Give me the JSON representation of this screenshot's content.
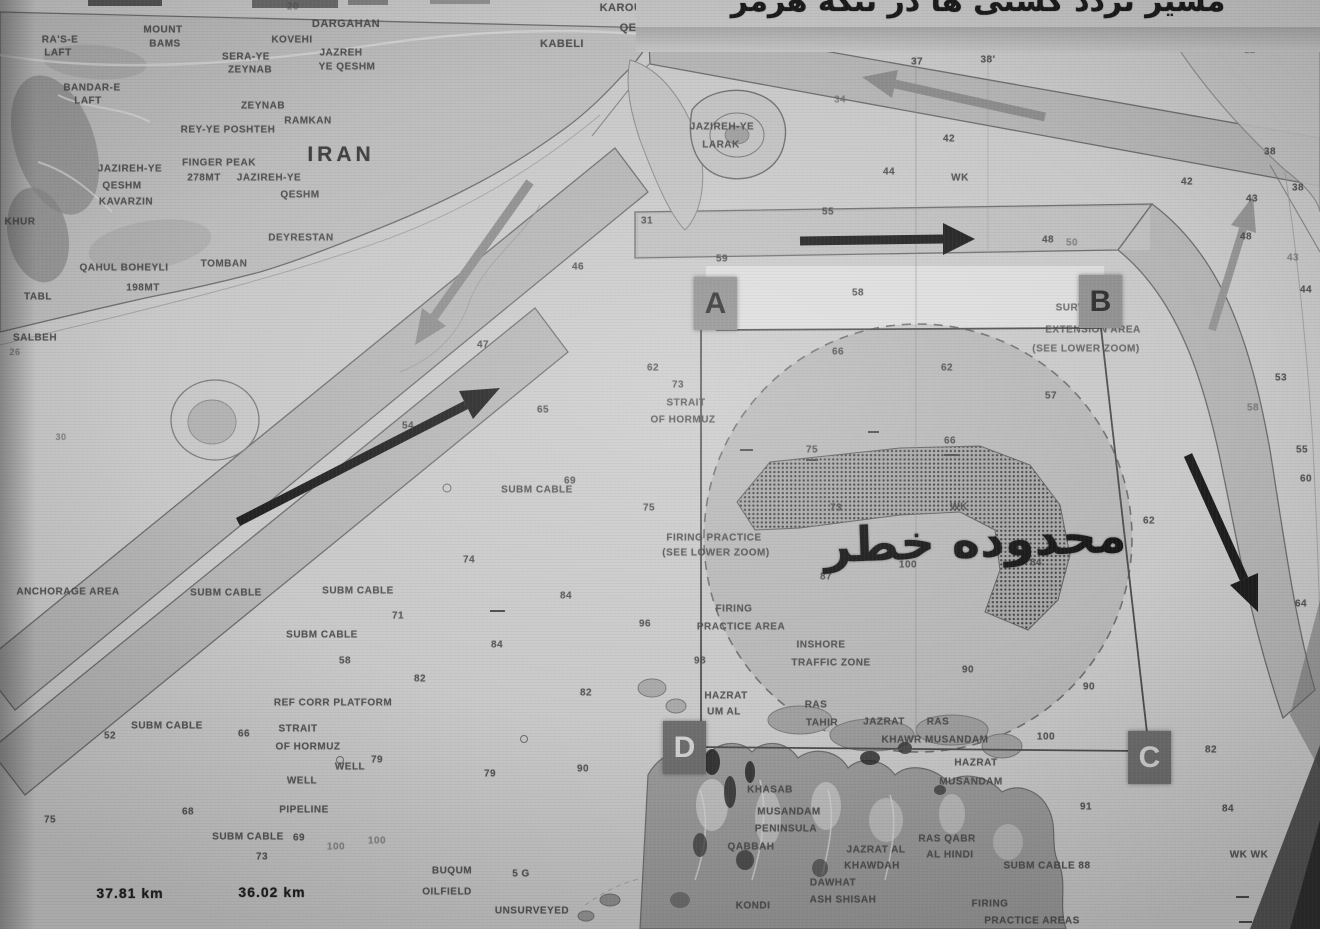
{
  "caption": {
    "text": "مسیر تردد کشتی ها در تنگه هرمز"
  },
  "danger_zone_label": "محدوده خطر",
  "markers": {
    "a": "A",
    "b": "B",
    "c": "C",
    "d": "D"
  },
  "colors": {
    "paper": "#c9c9c9",
    "land": "#bdbdbd",
    "dark_land": "#9a9a9a",
    "lane_fill": "#6e6e6e",
    "ink": "#474747",
    "arrow_black": "#1e1e1e",
    "arrow_gray": "#8d8d8d"
  },
  "labels": [
    {
      "t": "20",
      "x": 293,
      "y": 7,
      "s": 10,
      "c": "faint"
    },
    {
      "t": "KAROU",
      "x": 621,
      "y": 8,
      "s": 11
    },
    {
      "t": "QESHM",
      "x": 641,
      "y": 28,
      "s": 11
    },
    {
      "t": "KABELI",
      "x": 562,
      "y": 44,
      "s": 11
    },
    {
      "t": "DARGAHAN",
      "x": 346,
      "y": 24,
      "s": 11
    },
    {
      "t": "KOVEHI",
      "x": 292,
      "y": 40,
      "s": 10
    },
    {
      "t": "JAZREH",
      "x": 341,
      "y": 53,
      "s": 10
    },
    {
      "t": "YE QESHM",
      "x": 347,
      "y": 67,
      "s": 10
    },
    {
      "t": "SERA-YE",
      "x": 246,
      "y": 57,
      "s": 10
    },
    {
      "t": "ZEYNAB",
      "x": 250,
      "y": 70,
      "s": 10
    },
    {
      "t": "MOUNT",
      "x": 163,
      "y": 30,
      "s": 10
    },
    {
      "t": "BAMS",
      "x": 165,
      "y": 44,
      "s": 10
    },
    {
      "t": "RA'S-E",
      "x": 60,
      "y": 40,
      "s": 10
    },
    {
      "t": "LAFT",
      "x": 58,
      "y": 53,
      "s": 10
    },
    {
      "t": "BANDAR-E",
      "x": 92,
      "y": 88,
      "s": 10
    },
    {
      "t": "LAFT",
      "x": 88,
      "y": 101,
      "s": 10
    },
    {
      "t": "ZEYNAB",
      "x": 263,
      "y": 106,
      "s": 10
    },
    {
      "t": "RAMKAN",
      "x": 308,
      "y": 121,
      "s": 10
    },
    {
      "t": "REY-YE POSHTEH",
      "x": 228,
      "y": 130,
      "s": 10
    },
    {
      "t": "IRAN",
      "x": 341,
      "y": 155,
      "s": 21,
      "c": "big"
    },
    {
      "t": "FINGER PEAK",
      "x": 219,
      "y": 163,
      "s": 10
    },
    {
      "t": "278MT",
      "x": 204,
      "y": 178,
      "s": 10
    },
    {
      "t": "JAZIREH-YE",
      "x": 269,
      "y": 178,
      "s": 10
    },
    {
      "t": "QESHM",
      "x": 300,
      "y": 195,
      "s": 10
    },
    {
      "t": "JAZIREH-YE",
      "x": 130,
      "y": 169,
      "s": 10
    },
    {
      "t": "QESHM",
      "x": 122,
      "y": 186,
      "s": 10
    },
    {
      "t": "KAVARZIN",
      "x": 126,
      "y": 202,
      "s": 10
    },
    {
      "t": "KHUR",
      "x": 20,
      "y": 222,
      "s": 10
    },
    {
      "t": "DEYRESTAN",
      "x": 301,
      "y": 238,
      "s": 10
    },
    {
      "t": "QAHUL BOHEYLI",
      "x": 124,
      "y": 268,
      "s": 10
    },
    {
      "t": "TOMBAN",
      "x": 224,
      "y": 264,
      "s": 10
    },
    {
      "t": "198MT",
      "x": 143,
      "y": 288,
      "s": 10
    },
    {
      "t": "TABL",
      "x": 38,
      "y": 297,
      "s": 10
    },
    {
      "t": "SALBEH",
      "x": 35,
      "y": 338,
      "s": 10
    },
    {
      "t": "26",
      "x": 15,
      "y": 352,
      "s": 9,
      "c": "faint"
    },
    {
      "t": "30",
      "x": 61,
      "y": 437,
      "s": 9,
      "c": "faint"
    },
    {
      "t": "JAZIREH-YE",
      "x": 722,
      "y": 127,
      "s": 10
    },
    {
      "t": "LARAK",
      "x": 721,
      "y": 145,
      "s": 10
    },
    {
      "t": "37",
      "x": 917,
      "y": 62,
      "s": 10
    },
    {
      "t": "38'",
      "x": 988,
      "y": 60,
      "s": 10
    },
    {
      "t": "34",
      "x": 840,
      "y": 100,
      "s": 10,
      "c": "faint"
    },
    {
      "t": "42",
      "x": 949,
      "y": 139,
      "s": 10
    },
    {
      "t": "44",
      "x": 889,
      "y": 172,
      "s": 10
    },
    {
      "t": "WK",
      "x": 960,
      "y": 178,
      "s": 10
    },
    {
      "t": "WK",
      "x": 1297,
      "y": 8,
      "s": 10,
      "c": "faint"
    },
    {
      "t": "22",
      "x": 1250,
      "y": 50,
      "s": 9,
      "c": "faint"
    },
    {
      "t": "38",
      "x": 1270,
      "y": 152,
      "s": 10
    },
    {
      "t": "38",
      "x": 1298,
      "y": 188,
      "s": 10
    },
    {
      "t": "42",
      "x": 1187,
      "y": 182,
      "s": 10
    },
    {
      "t": "43",
      "x": 1252,
      "y": 199,
      "s": 10
    },
    {
      "t": "48",
      "x": 1246,
      "y": 237,
      "s": 10
    },
    {
      "t": "43",
      "x": 1293,
      "y": 258,
      "s": 10,
      "c": "faint"
    },
    {
      "t": "44",
      "x": 1306,
      "y": 290,
      "s": 10
    },
    {
      "t": "31",
      "x": 647,
      "y": 221,
      "s": 10
    },
    {
      "t": "55",
      "x": 828,
      "y": 212,
      "s": 10
    },
    {
      "t": "59",
      "x": 722,
      "y": 259,
      "s": 10
    },
    {
      "t": "46",
      "x": 578,
      "y": 267,
      "s": 10
    },
    {
      "t": "48",
      "x": 1048,
      "y": 240,
      "s": 10
    },
    {
      "t": "50",
      "x": 1072,
      "y": 243,
      "s": 10,
      "c": "faint"
    },
    {
      "t": "58",
      "x": 858,
      "y": 293,
      "s": 10
    },
    {
      "t": "SURVEYED",
      "x": 1085,
      "y": 308,
      "s": 10,
      "c": "note"
    },
    {
      "t": "EXTENSION AREA",
      "x": 1093,
      "y": 330,
      "s": 10,
      "c": "note"
    },
    {
      "t": "(SEE LOWER ZOOM)",
      "x": 1086,
      "y": 349,
      "s": 10,
      "c": "note"
    },
    {
      "t": "66",
      "x": 838,
      "y": 352,
      "s": 10
    },
    {
      "t": "62",
      "x": 947,
      "y": 368,
      "s": 10
    },
    {
      "t": "57",
      "x": 1051,
      "y": 396,
      "s": 10
    },
    {
      "t": "62",
      "x": 653,
      "y": 368,
      "s": 10
    },
    {
      "t": "73",
      "x": 678,
      "y": 385,
      "s": 10
    },
    {
      "t": "STRAIT",
      "x": 686,
      "y": 403,
      "s": 10
    },
    {
      "t": "OF HORMUZ",
      "x": 683,
      "y": 420,
      "s": 10
    },
    {
      "t": "47",
      "x": 483,
      "y": 345,
      "s": 10
    },
    {
      "t": "54",
      "x": 408,
      "y": 426,
      "s": 10
    },
    {
      "t": "65",
      "x": 543,
      "y": 410,
      "s": 10
    },
    {
      "t": "69",
      "x": 570,
      "y": 481,
      "s": 10
    },
    {
      "t": "SUBM CABLE",
      "x": 537,
      "y": 490,
      "s": 10
    },
    {
      "t": "75",
      "x": 649,
      "y": 508,
      "s": 10
    },
    {
      "t": "75",
      "x": 812,
      "y": 450,
      "s": 10
    },
    {
      "t": "66",
      "x": 950,
      "y": 441,
      "s": 10
    },
    {
      "t": "FIRING PRACTICE",
      "x": 714,
      "y": 538,
      "s": 10
    },
    {
      "t": "(SEE LOWER ZOOM)",
      "x": 716,
      "y": 553,
      "s": 10
    },
    {
      "t": "73",
      "x": 836,
      "y": 508,
      "s": 10
    },
    {
      "t": "WK",
      "x": 959,
      "y": 507,
      "s": 10
    },
    {
      "t": "100",
      "x": 908,
      "y": 565,
      "s": 10
    },
    {
      "t": "84",
      "x": 1036,
      "y": 563,
      "s": 10
    },
    {
      "t": "87",
      "x": 826,
      "y": 577,
      "s": 10
    },
    {
      "t": "74",
      "x": 469,
      "y": 560,
      "s": 10
    },
    {
      "t": "84",
      "x": 566,
      "y": 596,
      "s": 10
    },
    {
      "t": "58",
      "x": 345,
      "y": 661,
      "s": 10
    },
    {
      "t": "82",
      "x": 420,
      "y": 679,
      "s": 10
    },
    {
      "t": "SUBM CABLE",
      "x": 226,
      "y": 593,
      "s": 10
    },
    {
      "t": "SUBM CABLE",
      "x": 358,
      "y": 591,
      "s": 10
    },
    {
      "t": "SUBM CABLE",
      "x": 322,
      "y": 635,
      "s": 10
    },
    {
      "t": "SUBM CABLE",
      "x": 167,
      "y": 726,
      "s": 10
    },
    {
      "t": "SUBM CABLE",
      "x": 248,
      "y": 837,
      "s": 10
    },
    {
      "t": "ANCHORAGE AREA",
      "x": 68,
      "y": 592,
      "s": 10
    },
    {
      "t": "71",
      "x": 398,
      "y": 616,
      "s": 10
    },
    {
      "t": "84",
      "x": 497,
      "y": 645,
      "s": 10
    },
    {
      "t": "REF CORR PLATFORM",
      "x": 333,
      "y": 703,
      "s": 10
    },
    {
      "t": "STRAIT",
      "x": 298,
      "y": 729,
      "s": 10
    },
    {
      "t": "OF HORMUZ",
      "x": 308,
      "y": 747,
      "s": 10
    },
    {
      "t": "66",
      "x": 244,
      "y": 734,
      "s": 10
    },
    {
      "t": "52",
      "x": 110,
      "y": 736,
      "s": 10
    },
    {
      "t": "WELL",
      "x": 350,
      "y": 767,
      "s": 10
    },
    {
      "t": "79",
      "x": 377,
      "y": 760,
      "s": 10
    },
    {
      "t": "WELL",
      "x": 302,
      "y": 781,
      "s": 10
    },
    {
      "t": "79",
      "x": 490,
      "y": 774,
      "s": 10
    },
    {
      "t": "68",
      "x": 188,
      "y": 812,
      "s": 10
    },
    {
      "t": "75",
      "x": 50,
      "y": 820,
      "s": 10
    },
    {
      "t": "PIPELINE",
      "x": 304,
      "y": 810,
      "s": 10
    },
    {
      "t": "69",
      "x": 299,
      "y": 838,
      "s": 10
    },
    {
      "t": "73",
      "x": 262,
      "y": 857,
      "s": 10
    },
    {
      "t": "100",
      "x": 336,
      "y": 847,
      "s": 10,
      "c": "faint"
    },
    {
      "t": "100",
      "x": 377,
      "y": 841,
      "s": 10,
      "c": "faint"
    },
    {
      "t": "37.81 km",
      "x": 130,
      "y": 893,
      "s": 14,
      "c": "hand"
    },
    {
      "t": "36.02 km",
      "x": 272,
      "y": 892,
      "s": 14,
      "c": "hand"
    },
    {
      "t": "BUQUM",
      "x": 452,
      "y": 871,
      "s": 10
    },
    {
      "t": "OILFIELD",
      "x": 447,
      "y": 892,
      "s": 10
    },
    {
      "t": "5 G",
      "x": 521,
      "y": 874,
      "s": 10
    },
    {
      "t": "UNSURVEYED",
      "x": 532,
      "y": 911,
      "s": 10
    },
    {
      "t": "FIRING",
      "x": 734,
      "y": 609,
      "s": 10
    },
    {
      "t": "PRACTICE AREA",
      "x": 741,
      "y": 627,
      "s": 10
    },
    {
      "t": "INSHORE",
      "x": 821,
      "y": 645,
      "s": 10
    },
    {
      "t": "TRAFFIC ZONE",
      "x": 831,
      "y": 663,
      "s": 10
    },
    {
      "t": "96",
      "x": 645,
      "y": 624,
      "s": 10
    },
    {
      "t": "98",
      "x": 700,
      "y": 661,
      "s": 10
    },
    {
      "t": "90",
      "x": 968,
      "y": 670,
      "s": 10
    },
    {
      "t": "82",
      "x": 586,
      "y": 693,
      "s": 10
    },
    {
      "t": "90",
      "x": 583,
      "y": 769,
      "s": 10
    },
    {
      "t": "90",
      "x": 1089,
      "y": 687,
      "s": 10
    },
    {
      "t": "62",
      "x": 1149,
      "y": 521,
      "s": 10
    },
    {
      "t": "53",
      "x": 1281,
      "y": 378,
      "s": 10
    },
    {
      "t": "58",
      "x": 1253,
      "y": 408,
      "s": 10,
      "c": "faint"
    },
    {
      "t": "55",
      "x": 1302,
      "y": 450,
      "s": 10
    },
    {
      "t": "60",
      "x": 1306,
      "y": 479,
      "s": 10
    },
    {
      "t": "64",
      "x": 1301,
      "y": 604,
      "s": 10
    },
    {
      "t": "HAZRAT",
      "x": 726,
      "y": 696,
      "s": 10
    },
    {
      "t": "UM AL",
      "x": 724,
      "y": 712,
      "s": 10
    },
    {
      "t": "RAS",
      "x": 816,
      "y": 705,
      "s": 10
    },
    {
      "t": "TAHIR",
      "x": 822,
      "y": 723,
      "s": 10
    },
    {
      "t": "JAZRAT",
      "x": 884,
      "y": 722,
      "s": 10
    },
    {
      "t": "RAS",
      "x": 938,
      "y": 722,
      "s": 10
    },
    {
      "t": "KHAWR MUSANDAM",
      "x": 935,
      "y": 740,
      "s": 10
    },
    {
      "t": "100",
      "x": 1046,
      "y": 737,
      "s": 10
    },
    {
      "t": "HAZRAT",
      "x": 976,
      "y": 763,
      "s": 10
    },
    {
      "t": "MUSANDAM",
      "x": 971,
      "y": 782,
      "s": 10
    },
    {
      "t": "KHASAB",
      "x": 770,
      "y": 790,
      "s": 10
    },
    {
      "t": "MUSANDAM",
      "x": 789,
      "y": 812,
      "s": 10
    },
    {
      "t": "PENINSULA",
      "x": 786,
      "y": 829,
      "s": 10
    },
    {
      "t": "QABBAH",
      "x": 751,
      "y": 847,
      "s": 10
    },
    {
      "t": "RAS QABR",
      "x": 947,
      "y": 839,
      "s": 10
    },
    {
      "t": "AL HINDI",
      "x": 950,
      "y": 855,
      "s": 10
    },
    {
      "t": "JAZRAT AL",
      "x": 876,
      "y": 850,
      "s": 10
    },
    {
      "t": "KHAWDAH",
      "x": 872,
      "y": 866,
      "s": 10
    },
    {
      "t": "DAWHAT",
      "x": 833,
      "y": 883,
      "s": 10
    },
    {
      "t": "ASH SHISAH",
      "x": 843,
      "y": 900,
      "s": 10
    },
    {
      "t": "KONDI",
      "x": 753,
      "y": 906,
      "s": 10
    },
    {
      "t": "SUBM CABLE 88",
      "x": 1047,
      "y": 866,
      "s": 10
    },
    {
      "t": "91",
      "x": 1086,
      "y": 807,
      "s": 10
    },
    {
      "t": "82",
      "x": 1211,
      "y": 750,
      "s": 10
    },
    {
      "t": "84",
      "x": 1228,
      "y": 809,
      "s": 10
    },
    {
      "t": "WK WK",
      "x": 1249,
      "y": 855,
      "s": 10
    },
    {
      "t": "FIRING",
      "x": 990,
      "y": 904,
      "s": 10
    },
    {
      "t": "PRACTICE AREAS",
      "x": 1032,
      "y": 921,
      "s": 10
    }
  ]
}
